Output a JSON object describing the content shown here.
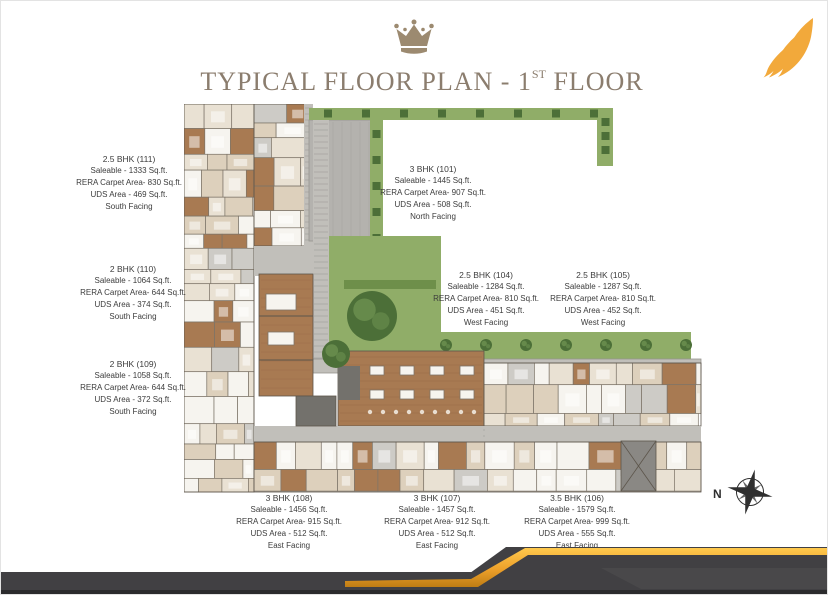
{
  "header": {
    "title_prefix": "TYPICAL FLOOR PLAN - 1",
    "title_sup": "ST",
    "title_suffix": " FLOOR"
  },
  "compass": {
    "label": "N"
  },
  "units": [
    {
      "id": "111",
      "name": "2.5 BHK (111)",
      "saleable": "Saleable - 1333 Sq.ft.",
      "rera": "RERA Carpet Area- 830 Sq.ft.",
      "uds": "UDS Area - 469 Sq.ft.",
      "facing": "South Facing"
    },
    {
      "id": "110",
      "name": "2 BHK (110)",
      "saleable": "Saleable - 1064 Sq.ft.",
      "rera": "RERA Carpet Area- 644 Sq.ft.",
      "uds": "UDS Area - 374 Sq.ft.",
      "facing": "South Facing"
    },
    {
      "id": "109",
      "name": "2 BHK (109)",
      "saleable": "Saleable - 1058 Sq.ft.",
      "rera": "RERA Carpet Area- 644 Sq.ft.",
      "uds": "UDS Area - 372 Sq.ft.",
      "facing": "South Facing"
    },
    {
      "id": "101",
      "name": "3 BHK (101)",
      "saleable": "Saleable - 1445 Sq.ft.",
      "rera": "RERA Carpet Area- 907 Sq.ft.",
      "uds": "UDS Area - 508 Sq.ft.",
      "facing": "North Facing"
    },
    {
      "id": "104",
      "name": "2.5 BHK (104)",
      "saleable": "Saleable - 1284 Sq.ft.",
      "rera": "RERA Carpet Area- 810 Sq.ft.",
      "uds": "UDS Area - 451 Sq.ft.",
      "facing": "West Facing"
    },
    {
      "id": "105",
      "name": "2.5 BHK (105)",
      "saleable": "Saleable - 1287 Sq.ft.",
      "rera": "RERA Carpet Area- 810 Sq.ft.",
      "uds": "UDS Area - 452 Sq.ft.",
      "facing": "West Facing"
    },
    {
      "id": "108",
      "name": "3 BHK (108)",
      "saleable": "Saleable - 1456 Sq.ft.",
      "rera": "RERA Carpet Area- 915 Sq.ft.",
      "uds": "UDS Area - 512 Sq.ft.",
      "facing": "East Facing"
    },
    {
      "id": "107",
      "name": "3 BHK (107)",
      "saleable": "Saleable - 1457 Sq.ft.",
      "rera": "RERA Carpet Area- 912 Sq.ft.",
      "uds": "UDS Area - 512 Sq.ft.",
      "facing": "East Facing"
    },
    {
      "id": "106",
      "name": "3.5 BHK (106)",
      "saleable": "Saleable - 1579 Sq.ft.",
      "rera": "RERA Carpet Area- 999 Sq.ft.",
      "uds": "UDS Area - 555 Sq.ft.",
      "facing": "East Facing"
    }
  ],
  "colors": {
    "title_text": "#8b7d6e",
    "crown": "#9c8a70",
    "logo_gold": "#f2a93b",
    "label_text": "#3c3c3c",
    "compass": "#2f2f2f",
    "band_dark": "#414043",
    "band_dark2": "#49484a",
    "band_deep": "#2b2b2d",
    "gold_light": "#ffc94d",
    "gold_mid": "#eda02a",
    "gold_dark": "#bf7d14"
  },
  "plan_colors": {
    "room_white": "#f6f4ef",
    "wall_beige": "#ddd0bc",
    "floor_beige": "#e9e1d3",
    "wood_brown": "#a87a52",
    "dark_brown": "#8d5f3c",
    "tile_gray": "#cdcbc6",
    "walk_gray": "#c1bfba",
    "terrace_gray": "#b4b2ae",
    "dark_gray": "#73716c",
    "lawn": "#90ad68",
    "hedge": "#6e8f4a",
    "tree": "#4c6f38",
    "tree_light": "#6d9150",
    "wall_line": "#7d7468",
    "outline": "#5d564c"
  }
}
